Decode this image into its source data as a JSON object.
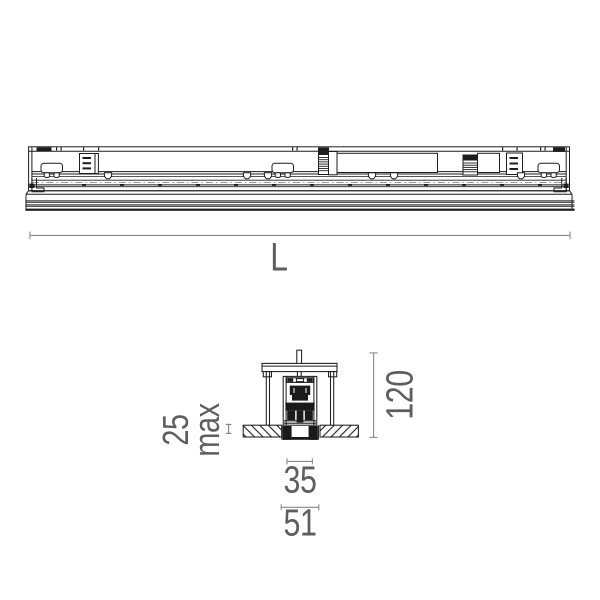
{
  "drawing": {
    "subject": "Recessed linear profile luminaire - dimensional drawing (side elevation and cross-section)",
    "colors": {
      "line": "#1d1d1d",
      "dimension_line": "#8a8a8a",
      "dimension_text": "#5e5e5e",
      "background": "#ffffff"
    },
    "elevation": {
      "length_label": "L"
    },
    "section": {
      "recess_depth": "25",
      "recess_depth_suffix": "max",
      "height": "120",
      "aperture_width": "35",
      "cutout_width": "51"
    }
  }
}
